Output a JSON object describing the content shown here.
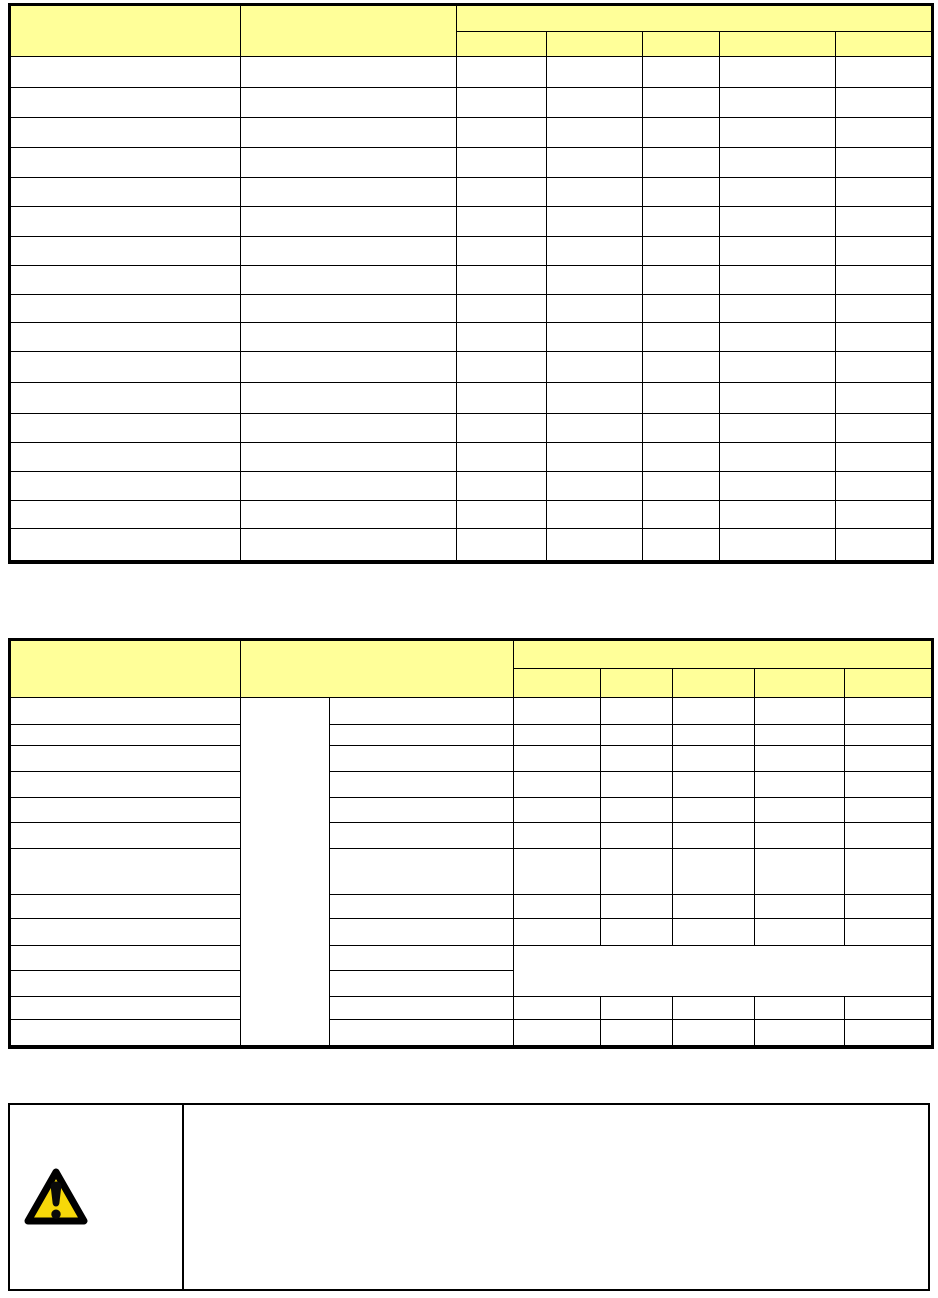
{
  "page": {
    "width": 938,
    "height": 1298,
    "background": "#FFFFFF"
  },
  "colors": {
    "table_header_fill": "#FFFF99",
    "table_border": "#000000",
    "warning_triangle_fill": "#F6D809",
    "warning_triangle_outline": "#000000"
  },
  "table1": {
    "header": {
      "col1": "",
      "col2": "",
      "group_title": "",
      "subheaders": [
        "",
        "",
        "",
        "",
        ""
      ]
    },
    "data_rows": [
      [
        "",
        "",
        "",
        "",
        "",
        "",
        ""
      ],
      [
        "",
        "",
        "",
        "",
        "",
        "",
        ""
      ],
      [
        "",
        "",
        "",
        "",
        "",
        "",
        ""
      ],
      [
        "",
        "",
        "",
        "",
        "",
        "",
        ""
      ],
      [
        "",
        "",
        "",
        "",
        "",
        "",
        ""
      ],
      [
        "",
        "",
        "",
        "",
        "",
        "",
        ""
      ],
      [
        "",
        "",
        "",
        "",
        "",
        "",
        ""
      ],
      [
        "",
        "",
        "",
        "",
        "",
        "",
        ""
      ],
      [
        "",
        "",
        "",
        "",
        "",
        "",
        ""
      ],
      [
        "",
        "",
        "",
        "",
        "",
        "",
        ""
      ],
      [
        "",
        "",
        "",
        "",
        "",
        "",
        ""
      ],
      [
        "",
        "",
        "",
        "",
        "",
        "",
        ""
      ],
      [
        "",
        "",
        "",
        "",
        "",
        "",
        ""
      ],
      [
        "",
        "",
        "",
        "",
        "",
        "",
        ""
      ],
      [
        "",
        "",
        "",
        "",
        "",
        "",
        ""
      ],
      [
        "",
        "",
        "",
        "",
        "",
        "",
        ""
      ],
      [
        "",
        "",
        "",
        "",
        "",
        "",
        ""
      ]
    ]
  },
  "table2": {
    "header": {
      "col1": "",
      "col2": "",
      "group_title": "",
      "subheaders": [
        "",
        "",
        "",
        "",
        ""
      ]
    },
    "data_rows": [
      [
        "",
        "",
        "",
        "",
        "",
        "",
        "",
        ""
      ],
      [
        "",
        "",
        "",
        "",
        "",
        "",
        ""
      ],
      [
        "",
        "",
        "",
        "",
        "",
        "",
        ""
      ],
      [
        "",
        "",
        "",
        "",
        "",
        "",
        ""
      ],
      [
        "",
        "",
        "",
        "",
        "",
        "",
        ""
      ],
      [
        "",
        "",
        "",
        "",
        "",
        "",
        ""
      ],
      [
        "",
        "",
        "",
        "",
        "",
        "",
        ""
      ],
      [
        "",
        "",
        "",
        "",
        "",
        "",
        ""
      ],
      [
        "",
        "",
        "",
        "",
        "",
        "",
        ""
      ],
      [
        "",
        "",
        ""
      ],
      [
        "",
        ""
      ],
      [
        "",
        "",
        "",
        "",
        "",
        "",
        ""
      ],
      [
        "",
        "",
        "",
        "",
        "",
        "",
        ""
      ]
    ]
  },
  "caution": {
    "icon": "warning-triangle-icon",
    "text": ""
  }
}
